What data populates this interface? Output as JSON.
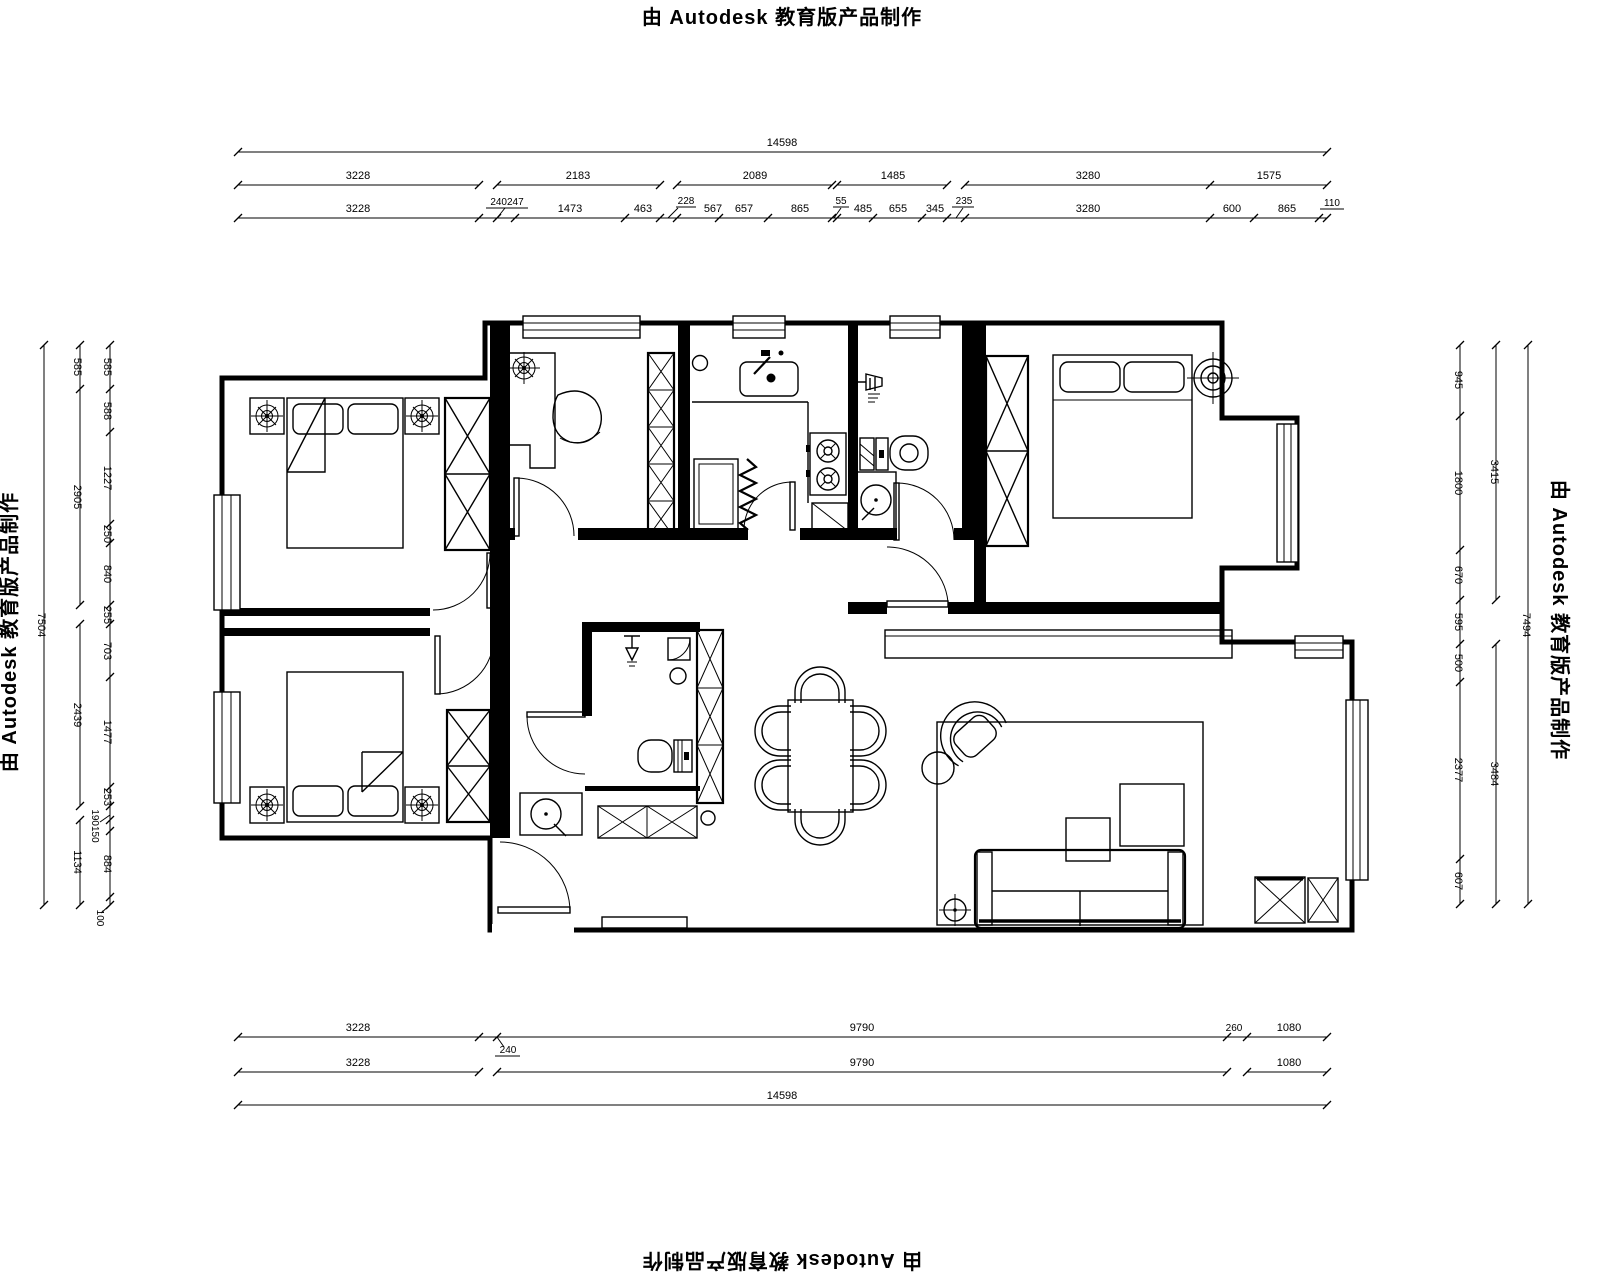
{
  "stamp": {
    "text": "由 Autodesk 教育版产品制作"
  },
  "dims": {
    "top_row1": "14598",
    "top_row2": [
      "3228",
      "2183",
      "2089",
      "1485",
      "3280",
      "1575"
    ],
    "top_row3": [
      "3228",
      "240247",
      "1473",
      "463",
      "228",
      "567",
      "657",
      "865",
      "55",
      "485",
      "655",
      "345",
      "235",
      "3280",
      "600",
      "865",
      "110"
    ],
    "bottom_row1": [
      "3228",
      "240",
      "9790",
      "260",
      "1080"
    ],
    "bottom_row2": [
      "3228",
      "9790",
      "1080"
    ],
    "bottom_row3": "14598",
    "left_col_outer": "7504",
    "left_col_mid": [
      "585",
      "2905",
      "2439",
      "1134"
    ],
    "left_col_inner": [
      "585",
      "588",
      "1227",
      "250",
      "840",
      "255",
      "703",
      "1477",
      "253",
      "190150",
      "884",
      "100"
    ],
    "right_col_inner": [
      "945",
      "1800",
      "670",
      "595",
      "500",
      "2377",
      "607"
    ],
    "right_col_mid": [
      "3415",
      "3484"
    ],
    "right_col_outer": "7494"
  }
}
